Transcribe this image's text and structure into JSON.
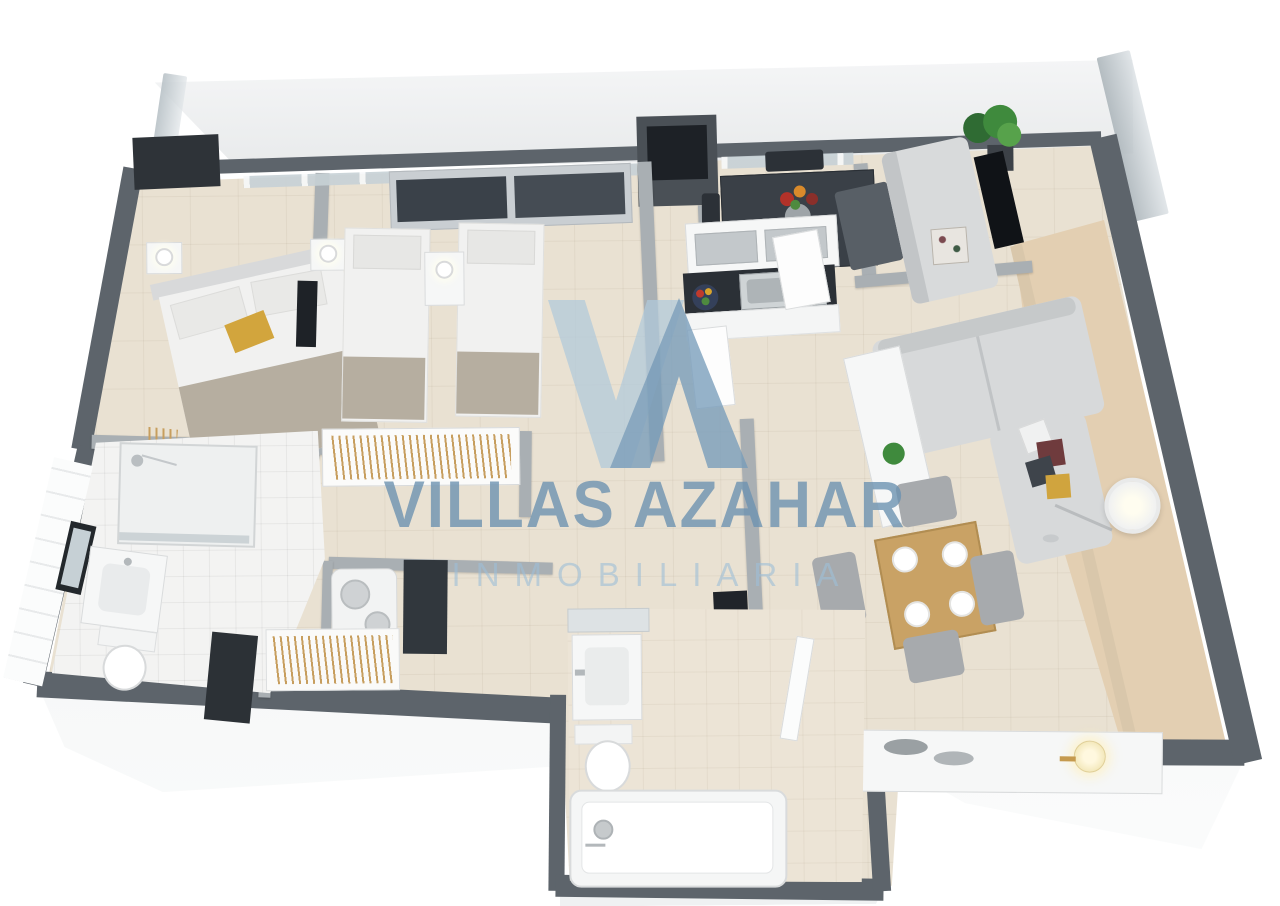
{
  "watermark": {
    "line1": "VILLAS AZAHAR",
    "line2": "INMOBILIARIA",
    "logo_color_light": "#b0c9db",
    "logo_color_dark": "#769bba",
    "text_color": "#6d92b0",
    "subtext_color": "#9ebfd6"
  },
  "palette": {
    "background": "#ffffff",
    "exterior_wall": "#5d646b",
    "interior_wall": "#a9afb3",
    "floor_main": "#e9e1d2",
    "floor_terrace_tan": "#e3cfb2",
    "floor_balcony": "#edeff0",
    "bathroom_tile": "#f3f3f2",
    "furniture_dark": "#33383e",
    "kitchen_counter_dark": "#2b3036",
    "wood": "#c9a265",
    "sofa_gray": "#d7d9da",
    "bed_blanket": "#b6aea0",
    "accent_yellow": "#d2a53d",
    "accent_red_pillow": "#6f3b3d",
    "plant_green": "#3f8a3d",
    "glass": "#c7d1d6"
  }
}
